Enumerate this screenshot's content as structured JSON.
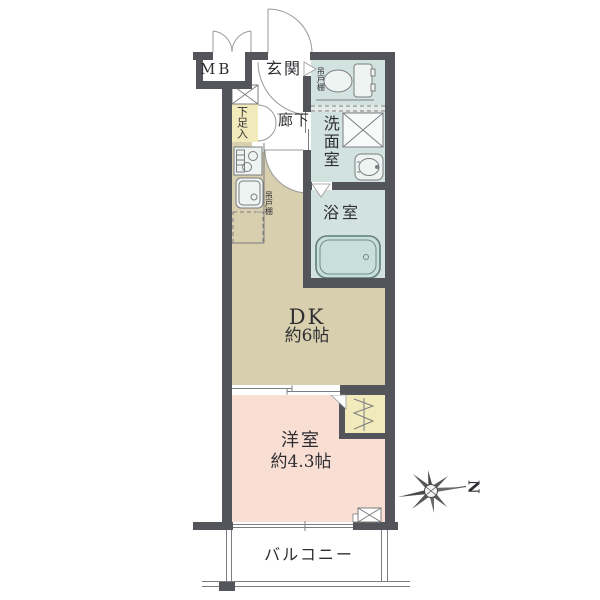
{
  "page": {
    "type": "apartment-floor-plan"
  },
  "labels": {
    "mb": "MB",
    "genkan": "玄関",
    "rouka": "廊下",
    "gesokuire": "下足入",
    "tsuridana": "吊戸棚",
    "senmenshitsu": "洗面室",
    "yokushitsu": "浴室",
    "dk_name": "DK",
    "dk_size": "約6帖",
    "yoshitsu_name": "洋室",
    "yoshitsu_size": "約4.3帖",
    "balcony": "バルコニー",
    "north": "N"
  },
  "colors": {
    "wall": "#54555a",
    "dk": "#d8cfae",
    "western": "#f9ded4",
    "wet": "#d2e2df",
    "fixture": "#eef4f2",
    "closet": "#f1eaba",
    "tub": "#c9dfdc",
    "hatch": "#e4eae8",
    "line": "#7c7d80",
    "arc": "#9a9a9a",
    "ink": "#2f2f33"
  },
  "compass": {
    "direction_letter": "N",
    "points_to": "right"
  }
}
